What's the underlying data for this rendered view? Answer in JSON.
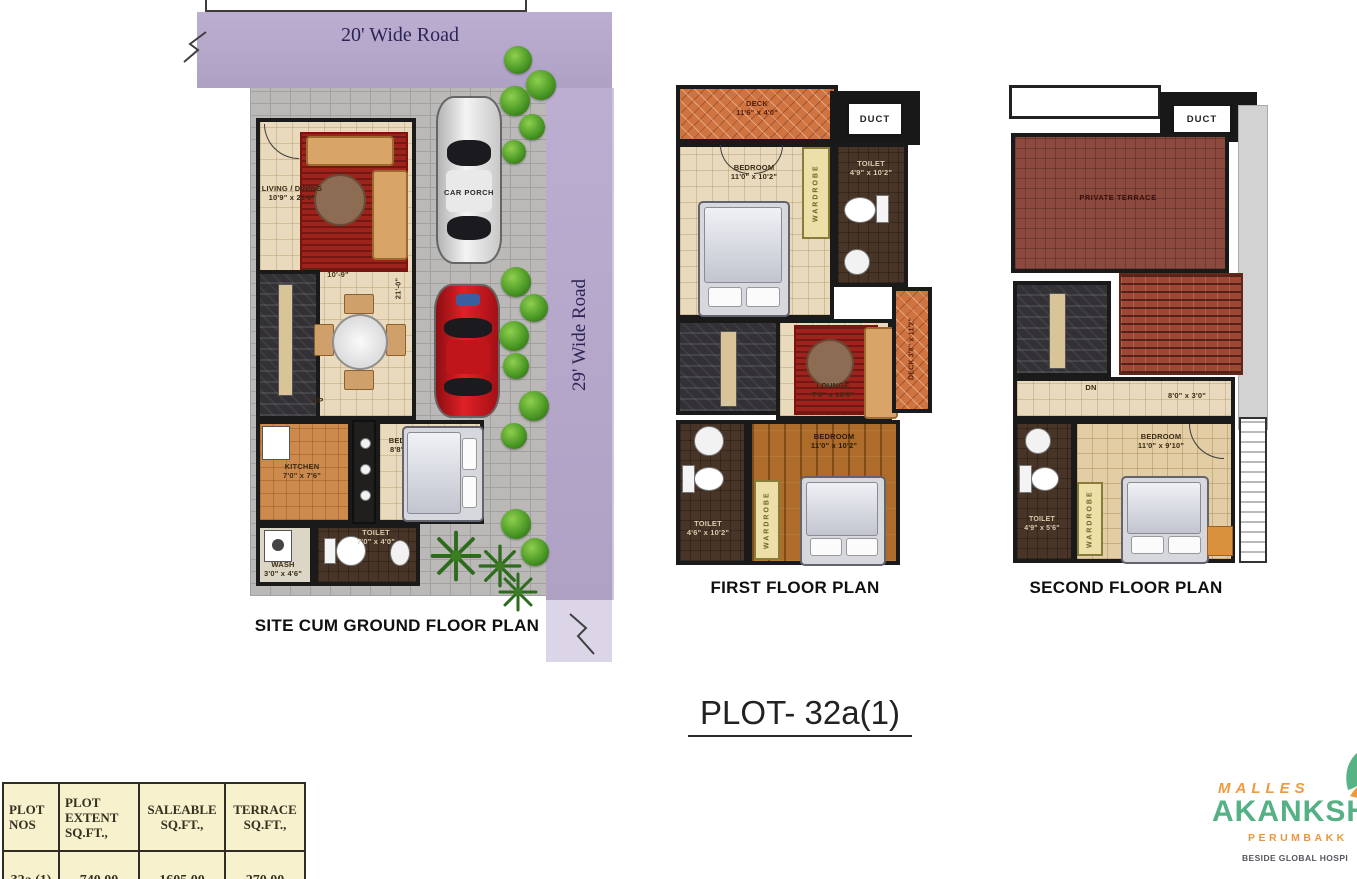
{
  "site": {
    "road_top": "20' Wide Road",
    "road_right": "29' Wide Road"
  },
  "ground": {
    "caption": "SITE CUM GROUND FLOOR PLAN",
    "living": {
      "name": "LIVING / DINING",
      "dim": "10'9\" x 21'0\""
    },
    "dim_width": "10'-9\"",
    "dim_height": "21'-0\"",
    "up": "UP",
    "car_porch": "CAR PORCH",
    "kitchen": {
      "name": "KITCHEN",
      "dim": "7'0\" x 7'6\""
    },
    "bedroom": {
      "name": "BEDROOM",
      "dim": "8'8\" x 7'6\""
    },
    "wash": {
      "name": "WASH",
      "dim": "3'0\" x 4'6\""
    },
    "toilet": {
      "name": "TOILET",
      "dim": "7'0\" x 4'0\""
    }
  },
  "first": {
    "caption": "FIRST FLOOR PLAN",
    "deck_top": {
      "name": "DECK",
      "dim": "11'6\" x 4'0\""
    },
    "duct": "DUCT",
    "bedroom_top": {
      "name": "BEDROOM",
      "dim": "11'0\" x 10'2\""
    },
    "toilet_top": {
      "name": "TOILET",
      "dim": "4'9\" x 10'2\""
    },
    "wardrobe": "WARDROBE",
    "up": "UP",
    "lounge": {
      "name": "LOUNGE",
      "dim": "7'0\" x 10'6\""
    },
    "deck_right": {
      "name": "DECK",
      "dim": "3'8\" x 11'2\""
    },
    "bedroom_bottom": {
      "name": "BEDROOM",
      "dim": "11'0\" x 10'2\""
    },
    "toilet_bottom": {
      "name": "TOILET",
      "dim": "4'6\" x 10'2\""
    }
  },
  "second": {
    "caption": "SECOND FLOOR PLAN",
    "duct": "DUCT",
    "terrace": "PRIVATE TERRACE",
    "dn": "DN",
    "hall_dim": "8'0\" x 3'0\"",
    "bedroom": {
      "name": "BEDROOM",
      "dim": "11'0\" x 9'10\""
    },
    "wardrobe": "WARDROBE",
    "toilet": {
      "name": "TOILET",
      "dim": "4'9\" x 5'6\""
    }
  },
  "plot_title": "PLOT- 32a(1)",
  "table": {
    "headers": [
      "PLOT NOS",
      "PLOT EXTENT SQ.FT.,",
      "SALEABLE SQ.FT.,",
      "TERRACE SQ.FT.,"
    ],
    "rows": [
      [
        "32a (1)",
        "740.00",
        "1605.00",
        "270.00"
      ]
    ]
  },
  "logo": {
    "brand": "MALLES",
    "name": "AKANKSH",
    "location": "PERUMBAKK",
    "tagline": "BESIDE GLOBAL HOSPI"
  },
  "colors": {
    "road": "#b5a7ca",
    "terrace": "#8c4a3e",
    "deck": "#cf7340",
    "brand_orange": "#ee9a3e",
    "brand_green": "#55b185"
  }
}
